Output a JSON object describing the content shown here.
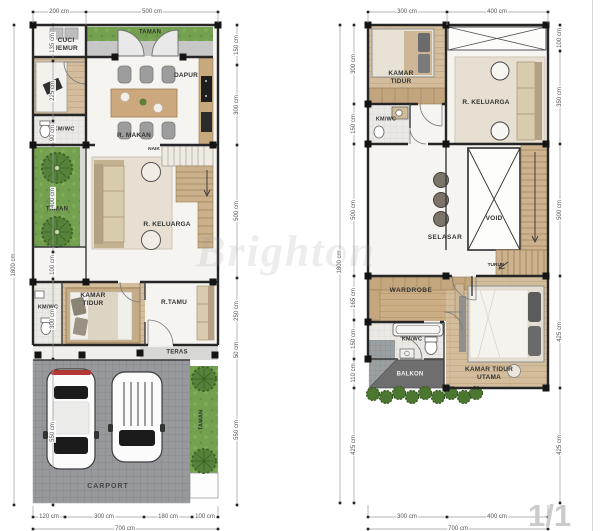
{
  "page": {
    "number": "1/1",
    "watermark": "Brighton",
    "unit": "cm"
  },
  "colors": {
    "wall": "#262626",
    "wood_floor": "#d3bd9d",
    "grass_green": "#74a14f",
    "paving_gray": "#97999c",
    "balcony_gray": "#6e6e6e",
    "dimension_text": "#555555",
    "accent_red": "#b23737"
  },
  "ground_floor": {
    "rooms": {
      "taman_top": "TAMAN",
      "cuci_jemur": "CUCI JEMUR",
      "dapur": "DAPUR",
      "km_wc_upper": "KM/WC",
      "r_makan": "R. MAKAN",
      "naik": "NAIK",
      "taman_side": "TAMAN",
      "r_keluarga": "R. KELUARGA",
      "km_wc_lower": "KM/WC",
      "kamar_tidur": "KAMAR TIDUR",
      "r_tamu": "R.TAMU",
      "teras": "TERAS",
      "carport": "CARPORT",
      "taman_front": "TAMAN"
    },
    "dims": {
      "top": [
        "200 cm",
        "500 cm"
      ],
      "left_total": "1800 cm",
      "left": [
        "135 cm",
        "225 cm",
        "90 cm",
        "400 cm",
        "100 cm",
        "300 cm",
        "550 cm"
      ],
      "right": [
        "150 cm",
        "300 cm",
        "500 cm",
        "250 cm",
        "50 cm",
        "550 cm"
      ],
      "bottom": [
        "120 cm",
        "300 cm",
        "180 cm",
        "100 cm"
      ],
      "bottom_total": "700 cm"
    }
  },
  "upper_floor": {
    "rooms": {
      "kamar_tidur": "KAMAR TIDUR",
      "r_keluarga": "R. KELUARGA",
      "km_wc_upper": "KM/WC",
      "selasar": "SELASAR",
      "void": "VOID",
      "turun": "TURUN",
      "wardrobe": "WARDROBE",
      "km_wc_lower": "KM/WC",
      "balkon": "BALKON",
      "kamar_tidur_utama": "KAMAR TIDUR UTAMA"
    },
    "dims": {
      "top": [
        "300 cm",
        "400 cm"
      ],
      "left_total": "1800 cm",
      "left": [
        "300 cm",
        "150 cm",
        "500 cm",
        "165 cm",
        "150 cm",
        "110 cm",
        "425 cm"
      ],
      "right": [
        "100 cm",
        "350 cm",
        "500 cm",
        "425 cm",
        "425 cm"
      ],
      "bottom": [
        "300 cm",
        "400 cm"
      ],
      "bottom_total": "700 cm"
    }
  }
}
